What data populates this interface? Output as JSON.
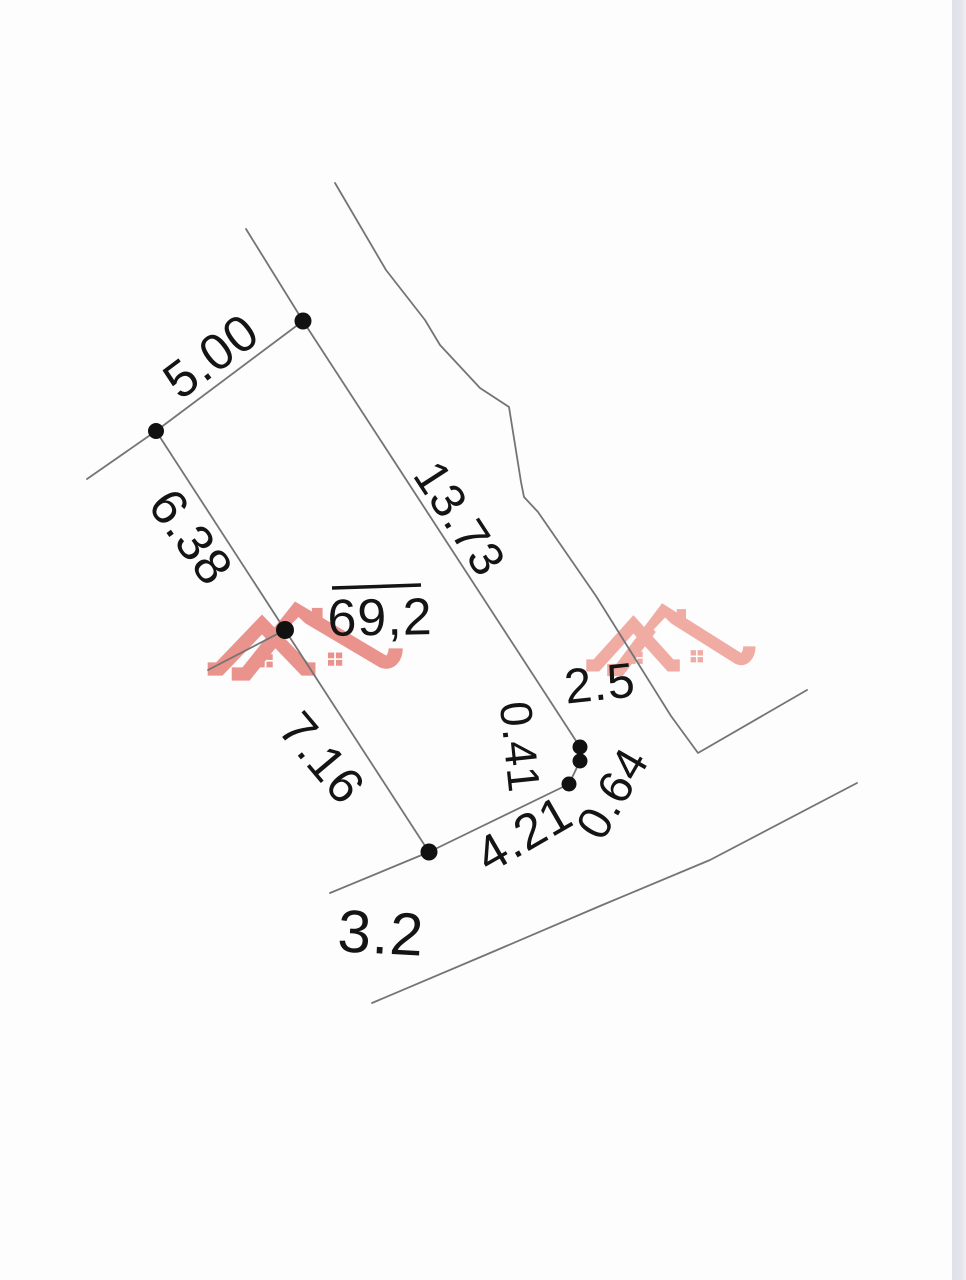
{
  "page": {
    "background": "#fdfdfe",
    "photo_edge": {
      "x": 952,
      "width": 14
    }
  },
  "drawing": {
    "width": 966,
    "height": 1280,
    "line_color": "#747474",
    "line_width": 1.8,
    "dot_color": "#111111",
    "text_color": "#141414",
    "lines": [
      {
        "name": "north-boundary-stub",
        "points": [
          [
            246,
            229
          ],
          [
            303,
            321
          ]
        ]
      },
      {
        "name": "parcel-edge-north-5.00",
        "points": [
          [
            303,
            321
          ],
          [
            156,
            431
          ]
        ]
      },
      {
        "name": "west-boundary-stub",
        "points": [
          [
            156,
            431
          ],
          [
            87,
            479
          ]
        ]
      },
      {
        "name": "parcel-edge-west-6.38",
        "points": [
          [
            156,
            431
          ],
          [
            285,
            630
          ]
        ]
      },
      {
        "name": "mid-west-boundary-stub",
        "points": [
          [
            285,
            630
          ],
          [
            208,
            670
          ]
        ]
      },
      {
        "name": "parcel-edge-west-7.16",
        "points": [
          [
            285,
            630
          ],
          [
            429,
            852
          ]
        ]
      },
      {
        "name": "south-boundary-stub",
        "points": [
          [
            429,
            852
          ],
          [
            330,
            893
          ]
        ]
      },
      {
        "name": "parcel-edge-south-4.21",
        "points": [
          [
            429,
            852
          ],
          [
            569,
            784
          ]
        ]
      },
      {
        "name": "parcel-edge-jog-0.64-0.41",
        "points": [
          [
            569,
            784
          ],
          [
            580,
            761
          ],
          [
            580,
            747
          ]
        ]
      },
      {
        "name": "parcel-edge-east-13.73",
        "points": [
          [
            580,
            747
          ],
          [
            303,
            321
          ]
        ]
      },
      {
        "name": "east-neighbor-boundary",
        "points": [
          [
            335,
            183
          ],
          [
            386,
            270
          ],
          [
            425,
            320
          ],
          [
            440,
            345
          ],
          [
            480,
            388
          ],
          [
            509,
            407
          ],
          [
            521,
            482
          ],
          [
            524,
            497
          ],
          [
            538,
            512
          ],
          [
            596,
            596
          ],
          [
            671,
            716
          ],
          [
            698,
            753
          ],
          [
            807,
            690
          ]
        ]
      },
      {
        "name": "road-south-edge",
        "points": [
          [
            372,
            1003
          ],
          [
            490,
            953
          ],
          [
            600,
            906
          ],
          [
            710,
            860
          ],
          [
            857,
            783
          ]
        ]
      }
    ],
    "vertices": [
      {
        "name": "vertex-dot-north",
        "x": 303,
        "y": 321,
        "r": 8.5
      },
      {
        "name": "vertex-dot-west",
        "x": 156,
        "y": 431,
        "r": 8.0
      },
      {
        "name": "vertex-dot-mid",
        "x": 285,
        "y": 630,
        "r": 9.0
      },
      {
        "name": "vertex-dot-south",
        "x": 429,
        "y": 852,
        "r": 8.5
      },
      {
        "name": "jog-dot-upper",
        "x": 580,
        "y": 747,
        "r": 7.5
      },
      {
        "name": "jog-dot-middle",
        "x": 580,
        "y": 761,
        "r": 7.5
      },
      {
        "name": "jog-dot-lower",
        "x": 569,
        "y": 784,
        "r": 7.5
      }
    ],
    "labels": [
      {
        "name": "5.00",
        "text": "5.00",
        "x": 211,
        "y": 356,
        "rotate": -37,
        "size": 51
      },
      {
        "name": "6.38",
        "text": "6.38",
        "x": 191,
        "y": 537,
        "rotate": 54,
        "size": 51
      },
      {
        "name": "7.16",
        "text": "7.16",
        "x": 322,
        "y": 758,
        "rotate": 50,
        "size": 50
      },
      {
        "name": "13.73",
        "text": "13.73",
        "x": 459,
        "y": 519,
        "rotate": 57,
        "size": 48
      },
      {
        "name": "69,2",
        "text": "69,2",
        "x": 380,
        "y": 618,
        "rotate": -1,
        "size": 52
      },
      {
        "name": "2.5",
        "text": "2.5",
        "x": 600,
        "y": 684,
        "rotate": -6,
        "size": 49
      },
      {
        "name": "0.41",
        "text": "0.41",
        "x": 520,
        "y": 747,
        "rotate": 84,
        "size": 45
      },
      {
        "name": "0.64",
        "text": "0.64",
        "x": 612,
        "y": 793,
        "rotate": -60,
        "size": 47
      },
      {
        "name": "4.21",
        "text": "4.21",
        "x": 524,
        "y": 834,
        "rotate": -30,
        "size": 50
      },
      {
        "name": "3.2",
        "text": "3.2",
        "x": 381,
        "y": 933,
        "rotate": 3,
        "size": 60
      }
    ],
    "area_overline": {
      "x1": 332,
      "y1": 588,
      "x2": 421,
      "y2": 585,
      "width": 3.5,
      "color": "#141414"
    },
    "watermarks": [
      {
        "name": "watermark-houses-logo-left",
        "x": 205,
        "y": 598,
        "width": 196,
        "height": 76,
        "color": "#e88b83",
        "opacity": 0.92
      },
      {
        "name": "watermark-houses-logo-right",
        "x": 584,
        "y": 600,
        "width": 170,
        "height": 70,
        "color": "#f0a79f",
        "opacity": 0.95
      }
    ]
  }
}
